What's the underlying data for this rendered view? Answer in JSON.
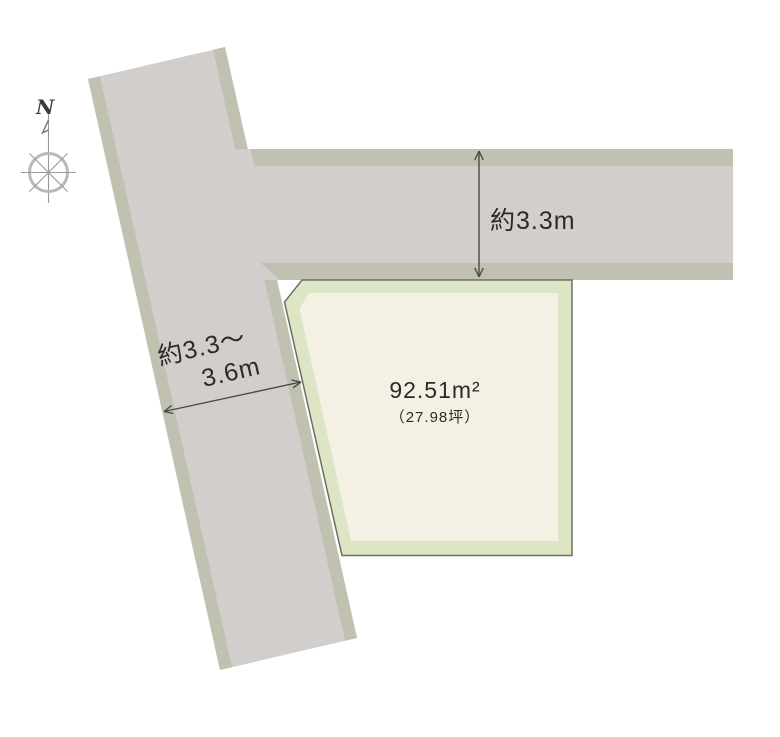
{
  "compass": {
    "north_label": "N"
  },
  "parcel": {
    "area_label": "92.51m²",
    "tsubo_label": "（27.98坪）"
  },
  "dimensions": {
    "top_road_width_label": "約3.3m",
    "left_road_width_line1": "約3.3～",
    "left_road_width_line2": "3.6m"
  },
  "colors": {
    "background": "#ffffff",
    "road_fill": "#d2cecc",
    "road_edge_strip": "#c1c1b2",
    "parcel_band": "#dde6c4",
    "parcel_fill": "#f4f1e4",
    "parcel_outline": "#6e6e64",
    "dimension_text": "#2b2b2b",
    "arrow": "#4a4a4a",
    "compass": "#9a9a9a"
  }
}
